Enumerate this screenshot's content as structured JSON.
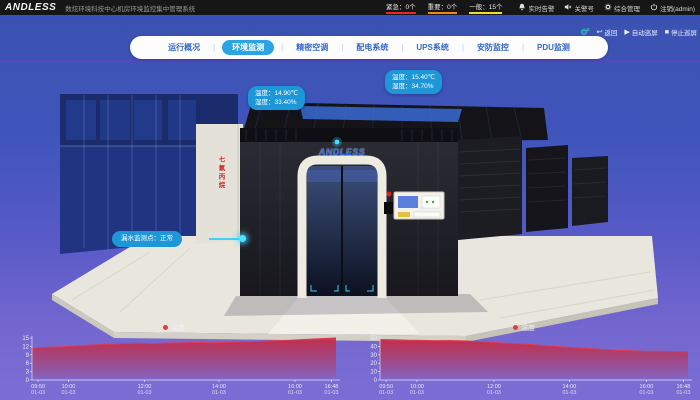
{
  "topbar": {
    "logo": "ANDLESS",
    "title": "数炫环境科技中心机房环境监控集中管理系统",
    "alarm_stats": [
      {
        "name": "alarm-stat-critical",
        "label": "紧急：",
        "count": "0个",
        "color": "#e8262b"
      },
      {
        "name": "alarm-stat-major",
        "label": "重要：",
        "count": "0个",
        "color": "#f08519"
      },
      {
        "name": "alarm-stat-general",
        "label": "一般：",
        "count": "15个",
        "color": "#f0e11c"
      }
    ],
    "actions": [
      {
        "name": "realtime-alarm-button",
        "icon": "bell-icon",
        "label": "实时告警"
      },
      {
        "name": "mute-alarm-button",
        "icon": "speaker-icon",
        "label": "关警号"
      },
      {
        "name": "management-button",
        "icon": "gear-icon",
        "label": "综合管理"
      },
      {
        "name": "logout-button",
        "icon": "power-icon",
        "label": "注销(admin)"
      }
    ]
  },
  "nav": {
    "tabs": [
      {
        "label": "运行概况",
        "active": false
      },
      {
        "label": "环境监测",
        "active": true
      },
      {
        "label": "精密空调",
        "active": false
      },
      {
        "label": "配电系统",
        "active": false
      },
      {
        "label": "UPS系统",
        "active": false
      },
      {
        "label": "安防监控",
        "active": false
      },
      {
        "label": "PDU监测",
        "active": false
      }
    ],
    "active_color": "#2aa4e4"
  },
  "toolbar": {
    "back": "返回",
    "auto_patrol": "自动巡屏",
    "stop_patrol": "停止巡屏"
  },
  "scene": {
    "container_logo": "ANDLESS",
    "cabinet_label": "七氟丙烷",
    "tooltips": [
      {
        "rows": [
          {
            "label": "温度：",
            "value": "15.40℃"
          },
          {
            "label": "湿度：",
            "value": "34.70%"
          }
        ]
      },
      {
        "rows": [
          {
            "label": "温度：",
            "value": "14.90℃"
          },
          {
            "label": "湿度：",
            "value": "33.40%"
          }
        ]
      }
    ],
    "leak": {
      "label": "漏水监测点：",
      "value": "正常"
    }
  },
  "chart_data": [
    {
      "type": "area",
      "legend": "温度",
      "legend_position": "top-center",
      "grid": false,
      "ylim": [
        0,
        15
      ],
      "y_ticks": [
        0,
        3,
        6,
        9,
        12,
        15
      ],
      "x_ticks": [
        {
          "time": "09:50",
          "date": "01-03",
          "frac": 0.02
        },
        {
          "time": "10:00",
          "date": "01-03",
          "frac": 0.12
        },
        {
          "time": "12:00",
          "date": "01-03",
          "frac": 0.37
        },
        {
          "time": "14:00",
          "date": "01-03",
          "frac": 0.615
        },
        {
          "time": "16:00",
          "date": "01-03",
          "frac": 0.865
        },
        {
          "time": "16:48",
          "date": "01-03",
          "frac": 0.985
        }
      ],
      "values": [
        11.4,
        11.7,
        11.9,
        12.2,
        12.5,
        12.8,
        13.0,
        13.1,
        13.0,
        13.2,
        13.3,
        13.4,
        13.3,
        13.5,
        13.6,
        13.8,
        14.0,
        14.2,
        14.5,
        14.8,
        15.0
      ],
      "area_color": "#c62b44",
      "line_color": "#e03a50"
    },
    {
      "type": "area",
      "legend": "湿度",
      "legend_position": "top-center",
      "grid": false,
      "ylim": [
        0,
        50
      ],
      "y_ticks": [
        0,
        10,
        20,
        30,
        40,
        50
      ],
      "x_ticks": [
        {
          "time": "09:50",
          "date": "01-03",
          "frac": 0.02
        },
        {
          "time": "10:00",
          "date": "01-03",
          "frac": 0.12
        },
        {
          "time": "12:00",
          "date": "01-03",
          "frac": 0.37
        },
        {
          "time": "14:00",
          "date": "01-03",
          "frac": 0.615
        },
        {
          "time": "16:00",
          "date": "01-03",
          "frac": 0.865
        },
        {
          "time": "16:48",
          "date": "01-03",
          "frac": 0.985
        }
      ],
      "values": [
        48.2,
        47.8,
        47.4,
        47.1,
        46.9,
        47.0,
        46.5,
        45.8,
        44.8,
        43.8,
        43.0,
        42.0,
        40.6,
        39.4,
        38.4,
        37.4,
        36.4,
        35.4,
        34.8,
        34.0,
        34.3,
        33.8,
        33.5
      ],
      "area_color": "#c62b44",
      "line_color": "#e03a50"
    }
  ]
}
